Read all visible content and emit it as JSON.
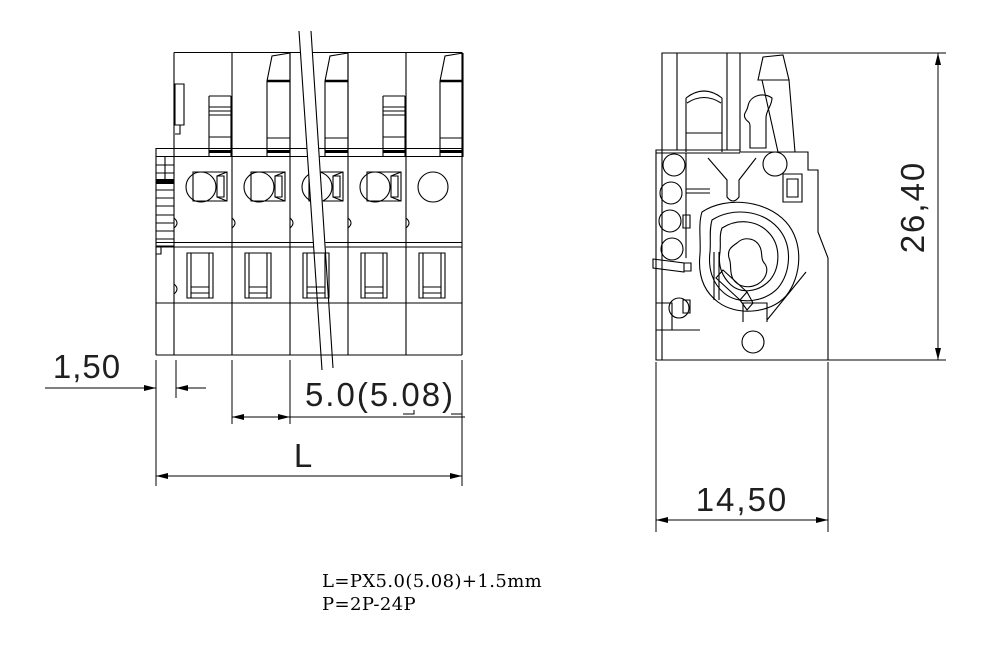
{
  "dimensions": {
    "front_margin": "1,50",
    "front_pitch": "5.0(5.08)",
    "front_length": "L",
    "side_height": "26,40",
    "side_width": "14,50"
  },
  "notes": {
    "formula": "L=PX5.0(5.08)+1.5mm",
    "positions": "P=2P-24P"
  },
  "colors": {
    "line": "#000000",
    "background": "#ffffff",
    "dim_text": "#1f1f1f"
  }
}
